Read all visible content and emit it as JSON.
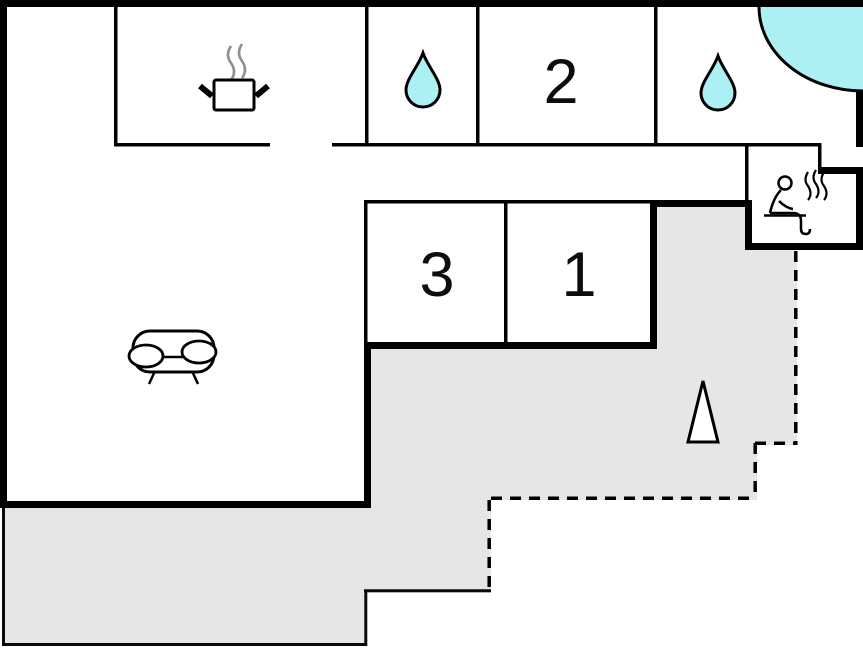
{
  "title": "holiday-home-floor-plan",
  "colors": {
    "background": "#ffffff",
    "wall": "#000000",
    "terrace": "#e6e6e6",
    "water": "#adf0f3",
    "steam": "#8f8f8f"
  },
  "rooms": {
    "bedroom1": {
      "label": "1"
    },
    "bedroom2": {
      "label": "2"
    },
    "bedroom3": {
      "label": "3"
    }
  },
  "icons": {
    "kitchen": "cooking-pot-icon",
    "bathroom_left": "water-drop-icon",
    "bathroom_right": "water-drop-icon",
    "corner_whirlpool": "whirlpool-corner-icon",
    "sauna": "sauna-person-icon",
    "living_room": "sofa-icon",
    "terrace": "tree-icon"
  }
}
